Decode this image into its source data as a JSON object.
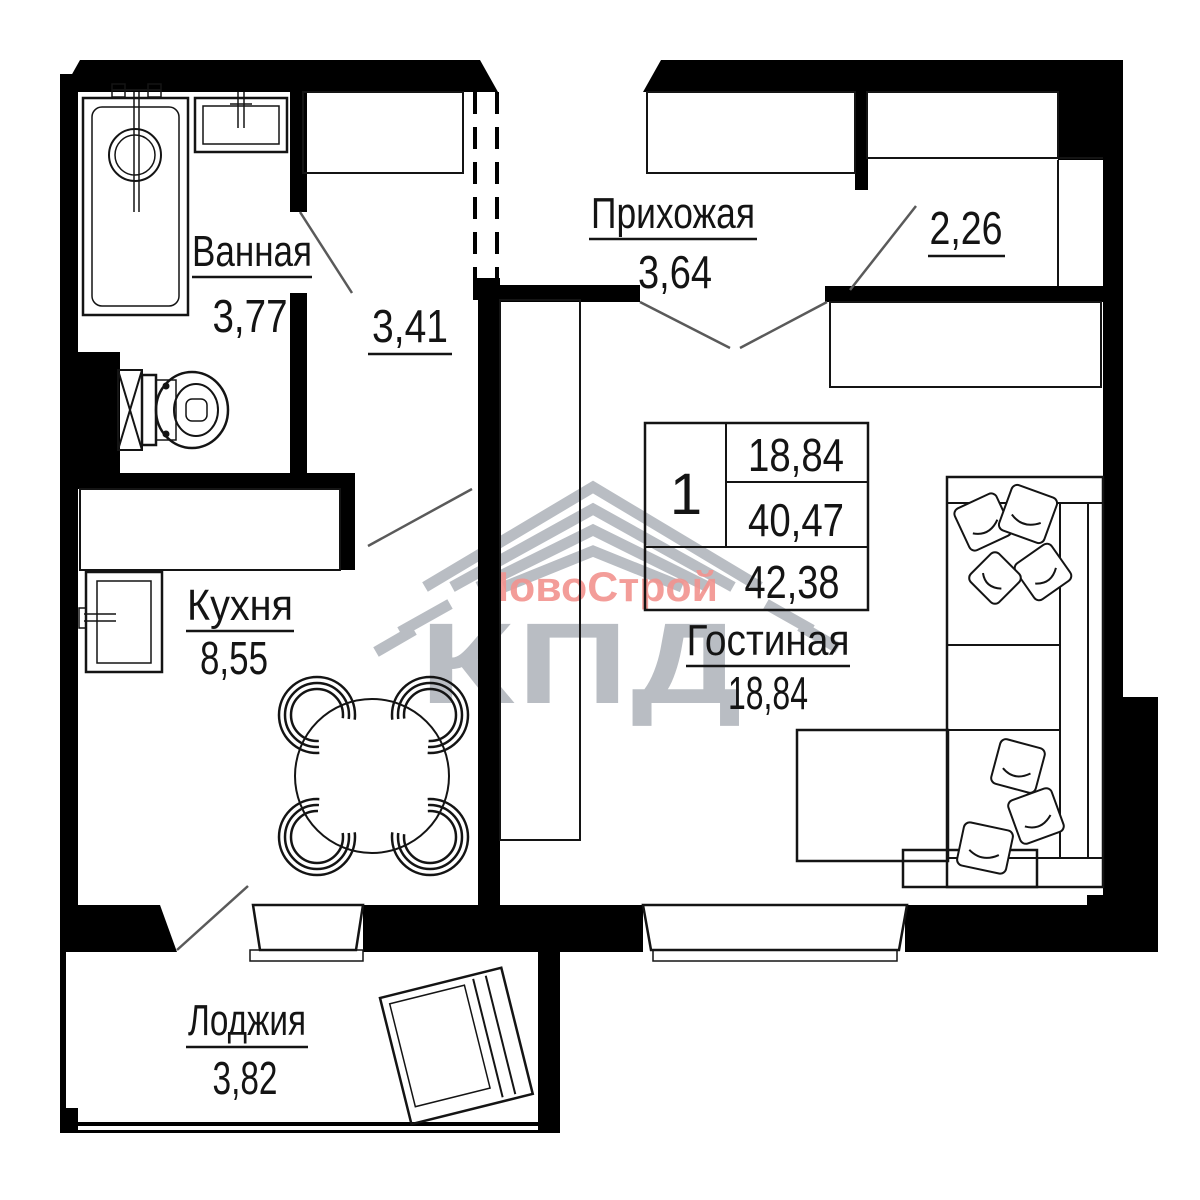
{
  "rooms": {
    "bathroom": {
      "label": "Ванная",
      "area": "3,77"
    },
    "hall_corridor": {
      "area": "3,41"
    },
    "entry_hall": {
      "label": "Прихожая",
      "area": "3,64"
    },
    "wardrobe_room": {
      "area": "2,26"
    },
    "kitchen": {
      "label": "Кухня",
      "area": "8,55"
    },
    "living_room": {
      "label": "Гостиная",
      "area": "18,84"
    },
    "loggia": {
      "label": "Лоджия",
      "area": "3,82"
    }
  },
  "info_table": {
    "rooms_count": "1",
    "living_area": "18,84",
    "area_without_loggia": "40,47",
    "total_area": "42,38"
  },
  "watermark": {
    "brand": "НовоСтрой",
    "company": "КПД"
  },
  "colors": {
    "wall": "#000000",
    "line": "#141414",
    "door_swing": "#5a5a5a",
    "watermark_gray": "#b9bdc3",
    "watermark_pink": "#f2938f"
  }
}
